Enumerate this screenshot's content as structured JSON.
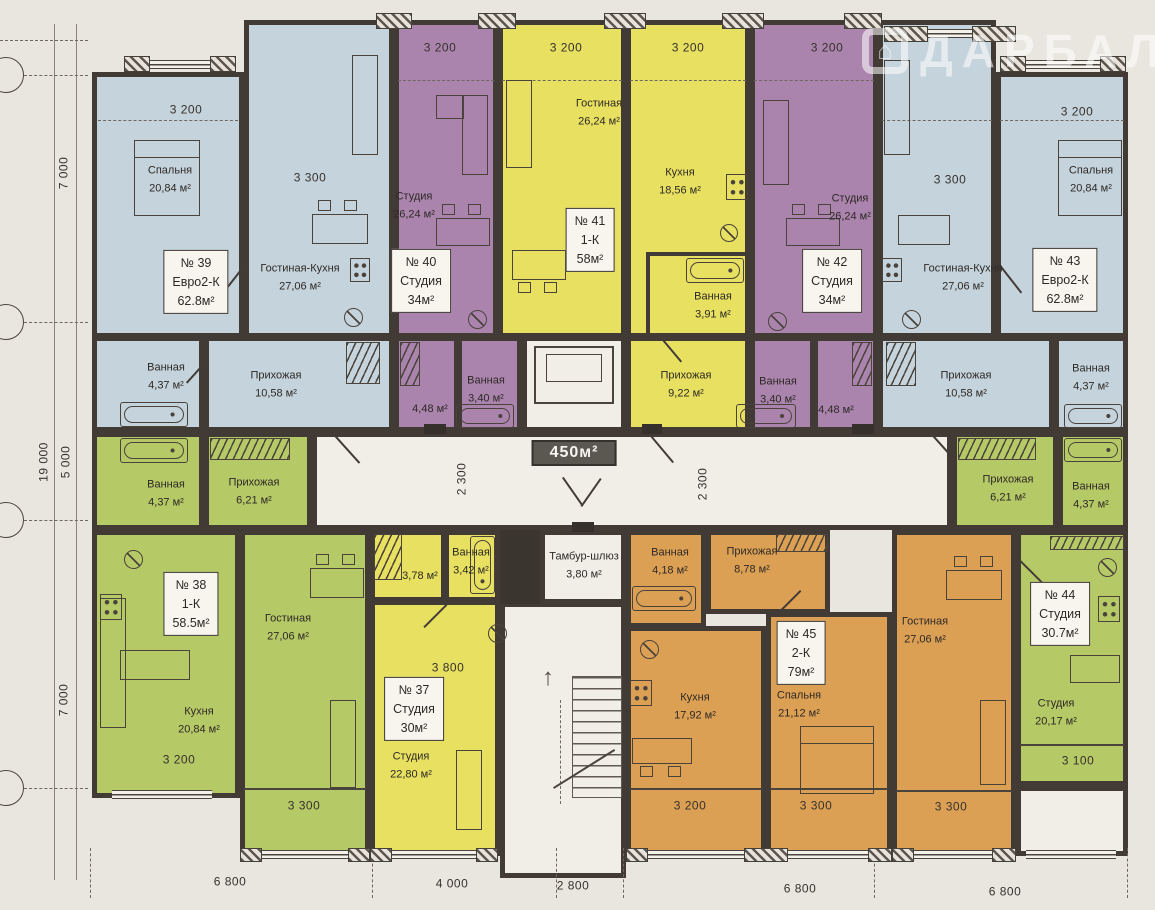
{
  "watermark": {
    "text": "ДАРБАЛТ"
  },
  "colors": {
    "blue": "#c5d3dc",
    "purple": "#ab84ae",
    "yellow": "#e8e061",
    "green": "#b6c967",
    "orange": "#dca055",
    "wall": "#423b35",
    "paper": "#e9e6df"
  },
  "common": {
    "floor_area_badge": "450м²",
    "tambur_name": "Тамбур-шлюз",
    "tambur_area": "3,80 м²",
    "corridor_dim_left": "2 300",
    "corridor_dim_right": "2 300"
  },
  "axis": {
    "left_top": "7 000",
    "left_total": "19 000",
    "left_mid": "5 000",
    "left_bottom": "7 000",
    "bottom": [
      "6 800",
      "4 000",
      "2 800",
      "6 800",
      "6 800"
    ]
  },
  "apartments": {
    "apt37": {
      "no": "№ 37",
      "type": "Студия",
      "area": "30м²",
      "studio_name": "Студия",
      "studio_area": "22,80 м²",
      "bath_name": "Ванная",
      "bath_area": "3,42 м²",
      "hall_area": "3,78 м²",
      "dim": "3 800"
    },
    "apt38": {
      "no": "№ 38",
      "type": "1-К",
      "area": "58.5м²",
      "living_name": "Гостиная",
      "living_area": "27,06 м²",
      "kitchen_name": "Кухня",
      "kitchen_area": "20,84 м²",
      "bath_name": "Ванная",
      "bath_area": "4,37 м²",
      "hall_name": "Прихожая",
      "hall_area": "6,21 м²",
      "dim_kitchen": "3 200",
      "dim_living": "3 300"
    },
    "apt39": {
      "no": "№ 39",
      "type": "Евро2-К",
      "area": "62.8м²",
      "bedroom_name": "Спальня",
      "bedroom_area": "20,84 м²",
      "living_name": "Гостиная-Кухня",
      "living_area": "27,06 м²",
      "hall_name": "Прихожая",
      "hall_area": "10,58 м²",
      "bath_name": "Ванная",
      "bath_area": "4,37 м²",
      "dim_bedroom": "3 200",
      "dim_living": "3 300"
    },
    "apt40": {
      "no": "№ 40",
      "type": "Студия",
      "area": "34м²",
      "studio_name": "Студия",
      "studio_area": "26,24 м²",
      "bath_name": "Ванная",
      "bath_area": "3,40 м²",
      "hall_area": "4,48 м²",
      "dim": "3 200"
    },
    "apt41": {
      "no": "№ 41",
      "type": "1-К",
      "area": "58м²",
      "living_name": "Гостиная",
      "living_area": "26,24 м²",
      "kitchen_name": "Кухня",
      "kitchen_area": "18,56 м²",
      "bath_name": "Ванная",
      "bath_area": "3,91 м²",
      "hall_name": "Прихожая",
      "hall_area": "9,22 м²",
      "dim_left": "3 200",
      "dim_right": "3 200"
    },
    "apt42": {
      "no": "№ 42",
      "type": "Студия",
      "area": "34м²",
      "studio_name": "Студия",
      "studio_area": "26,24 м²",
      "bath_name": "Ванная",
      "bath_area": "3,40 м²",
      "hall_area": "4,48 м²",
      "dim": "3 200"
    },
    "apt43": {
      "no": "№ 43",
      "type": "Евро2-К",
      "area": "62.8м²",
      "bedroom_name": "Спальня",
      "bedroom_area": "20,84 м²",
      "living_name": "Гостиная-Кухня",
      "living_area": "27,06 м²",
      "hall_name": "Прихожая",
      "hall_area": "10,58 м²",
      "bath_name": "Ванная",
      "bath_area": "4,37 м²",
      "dim_bedroom": "3 200",
      "dim_living": "3 300"
    },
    "apt44": {
      "no": "№ 44",
      "type": "Студия",
      "area": "30.7м²",
      "studio_name": "Студия",
      "studio_area": "20,17 м²",
      "bath_name": "Ванная",
      "bath_area": "4,37 м²",
      "hall_name": "Прихожая",
      "hall_area": "6,21 м²",
      "dim": "3 100"
    },
    "apt45": {
      "no": "№ 45",
      "type": "2-К",
      "area": "79м²",
      "kitchen_name": "Кухня",
      "kitchen_area": "17,92 м²",
      "bedroom_name": "Спальня",
      "bedroom_area": "21,12 м²",
      "living_name": "Гостиная",
      "living_area": "27,06 м²",
      "bath_name": "Ванная",
      "bath_area": "4,18 м²",
      "hall_name": "Прихожая",
      "hall_area": "8,78 м²",
      "dim_kitchen": "3 200",
      "dim_bedroom": "3 300",
      "dim_living": "3 300"
    }
  }
}
